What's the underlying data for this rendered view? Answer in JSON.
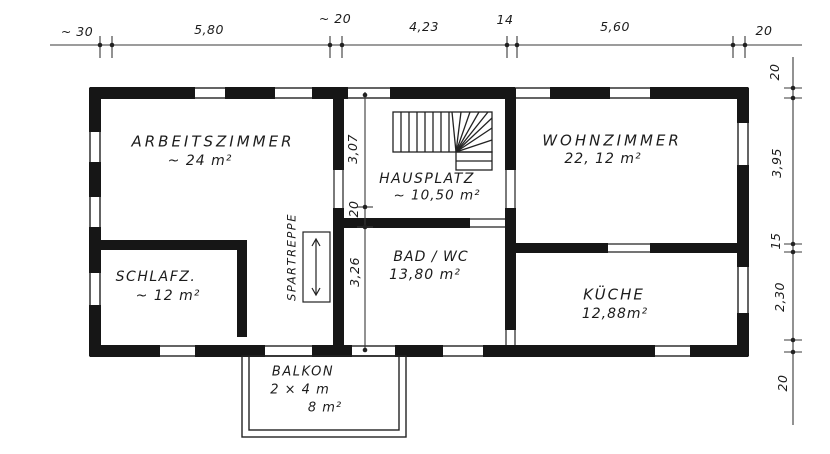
{
  "colors": {
    "ink": "#1c1c1c",
    "paper": "#ffffff"
  },
  "rooms": {
    "arbeitszimmer": {
      "name": "ARBEITSZIMMER",
      "area": "~ 24 m²"
    },
    "schlafzimmer": {
      "name": "SCHLAFZ.",
      "area": "~ 12 m²"
    },
    "hausplatz": {
      "name": "HAUSPLATZ",
      "area": "~ 10,50 m²"
    },
    "wohnzimmer": {
      "name": "WOHNZIMMER",
      "area": "22, 12 m²"
    },
    "bad_wc": {
      "name": "BAD / WC",
      "area": "13,80 m²"
    },
    "kueche": {
      "name": "KÜCHE",
      "area": "12,88m²"
    },
    "balkon": {
      "name": "BALKON",
      "size": "2 × 4 m",
      "area": "8 m²"
    }
  },
  "stair": {
    "label": "SPARTREPPE"
  },
  "dimensions": {
    "top": [
      "~ 30",
      "5,80",
      "~ 20",
      "4,23",
      "14",
      "5,60",
      "20"
    ],
    "right": [
      "20",
      "3,95",
      "15",
      "2,30",
      "20"
    ],
    "middle": [
      "3,07",
      "20",
      "3,26"
    ]
  }
}
